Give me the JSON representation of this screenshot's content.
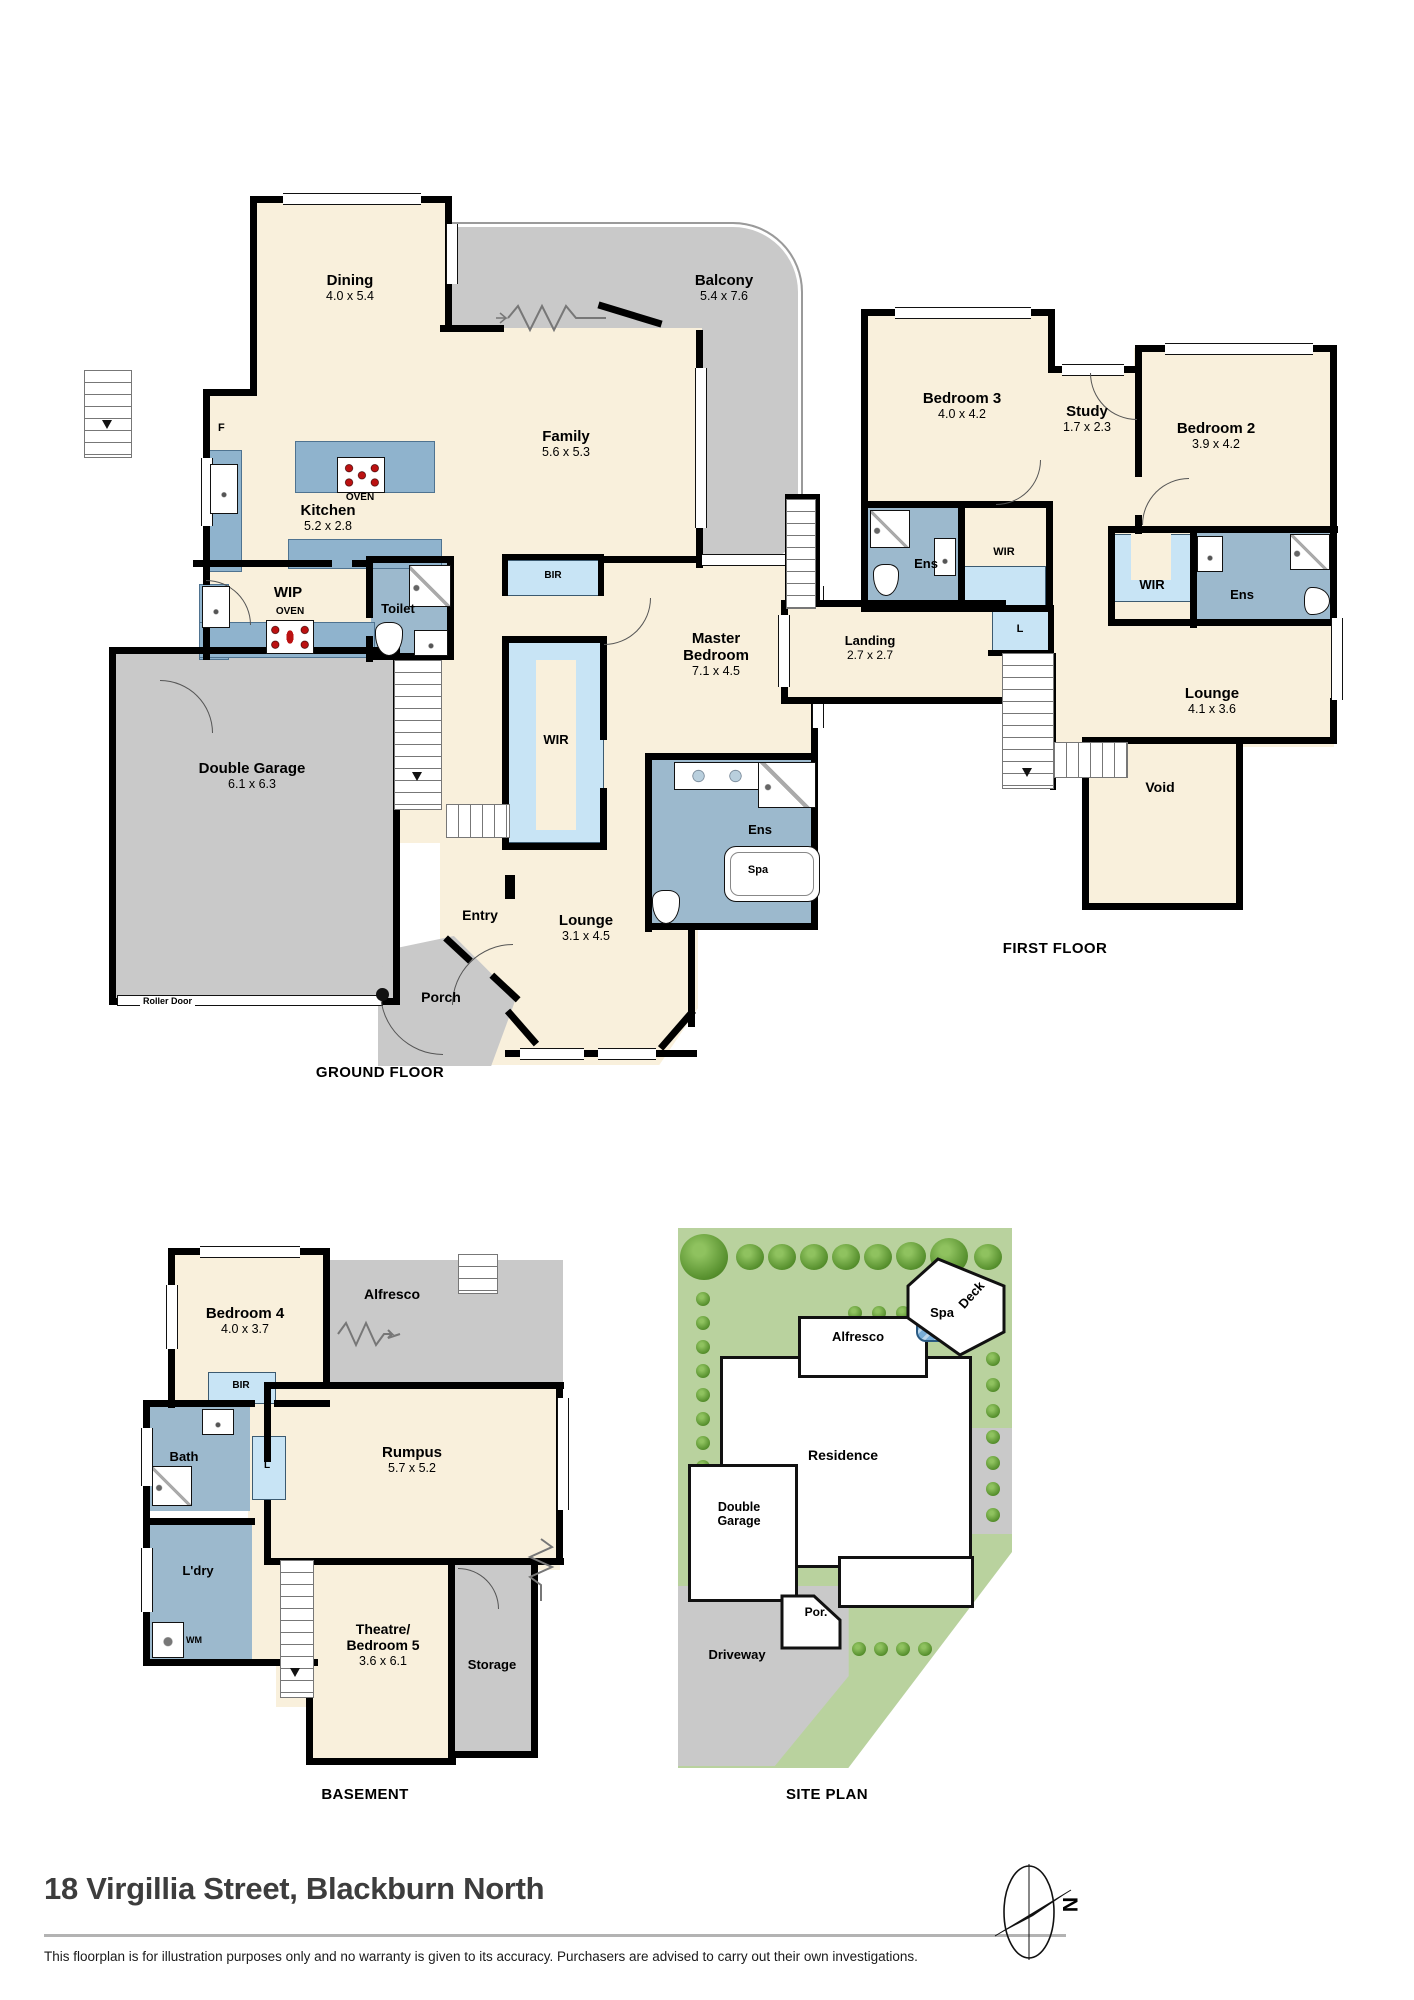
{
  "title": "18 Virgillia Street, Blackburn North",
  "disclaimer": "This floorplan is for illustration purposes only and no warranty is given to its accuracy. Purchasers are advised to carry out their own investigations.",
  "compass": {
    "north_label": "N"
  },
  "colors": {
    "floor_cream": "#f9f0dc",
    "outdoor_grey": "#c9c9c9",
    "wet_blue": "#9cb9cd",
    "robe_blue": "#c8e4f5",
    "bench_blue": "#8fb3cd",
    "lawn_green": "#b9d29e",
    "tree_green": "#568f2d"
  },
  "ground_floor": {
    "label": "GROUND FLOOR",
    "dining": {
      "name": "Dining",
      "dims": "4.0 x 5.4"
    },
    "balcony": {
      "name": "Balcony",
      "dims": "5.4 x 7.6"
    },
    "family": {
      "name": "Family",
      "dims": "5.6 x 5.3"
    },
    "kitchen": {
      "name": "Kitchen",
      "dims": "5.2 x 2.8"
    },
    "fridge": "F",
    "island_oven": "OVEN",
    "wip": {
      "name": "WIP",
      "oven": "OVEN"
    },
    "toilet": {
      "name": "Toilet"
    },
    "bir": "BIR",
    "wir": "WIR",
    "master_bedroom": {
      "name": "Master Bedroom",
      "dims": "7.1 x 4.5"
    },
    "ens": {
      "name": "Ens",
      "spa": "Spa"
    },
    "garage": {
      "name": "Double Garage",
      "dims": "6.1 x 6.3",
      "roller_door": "Roller Door"
    },
    "entry": {
      "name": "Entry"
    },
    "lounge": {
      "name": "Lounge",
      "dims": "3.1 x 4.5"
    },
    "porch": {
      "name": "Porch"
    }
  },
  "first_floor": {
    "label": "FIRST FLOOR",
    "bedroom3": {
      "name": "Bedroom 3",
      "dims": "4.0 x 4.2"
    },
    "study": {
      "name": "Study",
      "dims": "1.7 x 2.3"
    },
    "bedroom2": {
      "name": "Bedroom 2",
      "dims": "3.9 x 4.2"
    },
    "ens3": {
      "name": "Ens"
    },
    "wir3": {
      "name": "WIR"
    },
    "wir2": {
      "name": "WIR"
    },
    "ens2": {
      "name": "Ens"
    },
    "linen": "L",
    "landing": {
      "name": "Landing",
      "dims": "2.7 x 2.7"
    },
    "lounge": {
      "name": "Lounge",
      "dims": "4.1 x 3.6"
    },
    "void": {
      "name": "Void"
    }
  },
  "basement": {
    "label": "BASEMENT",
    "bedroom4": {
      "name": "Bedroom 4",
      "dims": "4.0 x 3.7"
    },
    "alfresco": {
      "name": "Alfresco"
    },
    "bir": "BIR",
    "bath": {
      "name": "Bath"
    },
    "linen": "L",
    "rumpus": {
      "name": "Rumpus",
      "dims": "5.7 x 5.2"
    },
    "laundry": {
      "name": "L'dry",
      "wm": "WM"
    },
    "theatre": {
      "name": "Theatre/ Bedroom 5",
      "dims": "3.6 x 6.1"
    },
    "storage": {
      "name": "Storage"
    }
  },
  "site_plan": {
    "label": "SITE PLAN",
    "deck": "Deck",
    "spa": "Spa",
    "alfresco": "Alfresco",
    "residence": "Residence",
    "garage": "Double Garage",
    "porch": "Por.",
    "driveway": "Driveway"
  }
}
